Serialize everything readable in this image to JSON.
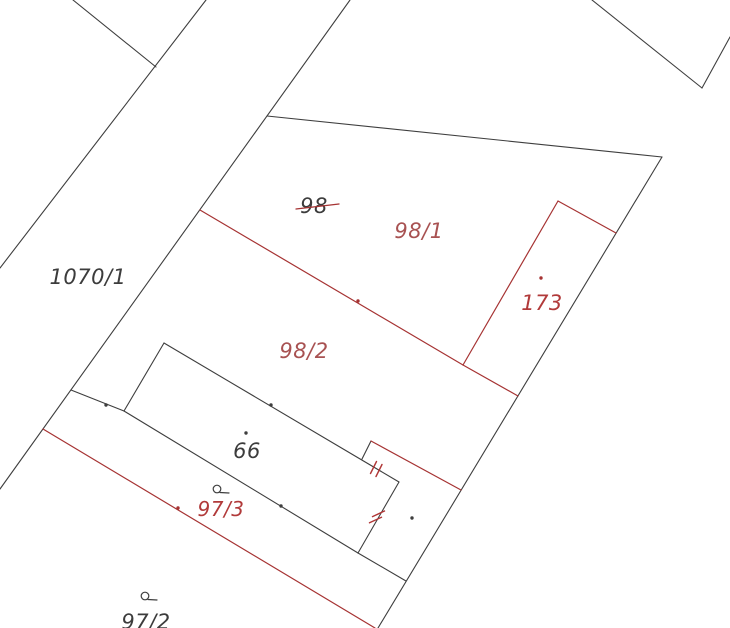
{
  "map": {
    "width": 730,
    "height": 628,
    "background": "#ffffff",
    "colors": {
      "boundary": "#3e3e3e",
      "new_boundary": "#a63333",
      "tick": "#b03636",
      "label_black": "#3c3c3c",
      "label_red": "#b13a3a",
      "label_red_muted": "#a85252"
    },
    "black_lines": [
      {
        "name": "road-west-boundary",
        "pts": [
          206,
          0,
          0,
          268
        ]
      },
      {
        "name": "field-line-northwest",
        "pts": [
          73,
          0,
          156,
          67
        ]
      },
      {
        "name": "road-east-boundary",
        "pts": [
          350,
          0,
          0,
          489
        ]
      },
      {
        "name": "parcel-98-north-boundary",
        "pts": [
          267,
          116,
          662,
          157
        ]
      },
      {
        "name": "parcel-98-east-boundary",
        "pts": [
          662,
          157,
          378,
          628
        ]
      },
      {
        "name": "northeast-corner-line-a",
        "pts": [
          592,
          0,
          702,
          88
        ]
      },
      {
        "name": "northeast-corner-line-b",
        "pts": [
          702,
          88,
          730,
          37
        ]
      },
      {
        "name": "road-to-building-connector",
        "pts": [
          71,
          390,
          124,
          411
        ]
      },
      {
        "name": "building-66-north-side",
        "pts": [
          164,
          343,
          399,
          482
        ]
      },
      {
        "name": "building-66-east-side",
        "pts": [
          399,
          482,
          358,
          553
        ]
      },
      {
        "name": "building-66-south-side",
        "pts": [
          358,
          553,
          124,
          411
        ]
      },
      {
        "name": "building-66-west-side",
        "pts": [
          124,
          411,
          164,
          343
        ]
      },
      {
        "name": "building-corner-spur",
        "pts": [
          362,
          459,
          371,
          441
        ]
      },
      {
        "name": "south-side-extension",
        "pts": [
          358,
          553,
          406,
          581
        ]
      }
    ],
    "red_lines": [
      {
        "name": "new-boundary-98-1-98-2-a",
        "pts": [
          200,
          210,
          463,
          365
        ]
      },
      {
        "name": "new-boundary-98-1-98-2-b",
        "pts": [
          463,
          365,
          518,
          396
        ]
      },
      {
        "name": "new-parcel-173-north-side",
        "pts": [
          558,
          201,
          616,
          233
        ]
      },
      {
        "name": "new-parcel-173-west-side",
        "pts": [
          558,
          201,
          463,
          365
        ]
      },
      {
        "name": "new-boundary-97-3-north",
        "pts": [
          371,
          441,
          461,
          490
        ]
      },
      {
        "name": "new-boundary-97-3-south",
        "pts": [
          43,
          429,
          375,
          628
        ]
      }
    ],
    "strike_line": {
      "name": "old-number-98-strikethrough",
      "pts": [
        296,
        209,
        339,
        204
      ]
    },
    "tick_marks": [
      {
        "name": "merge-tick-north-a",
        "pts": [
          370.5,
          473.5,
          376.5,
          461.5
        ]
      },
      {
        "name": "merge-tick-north-b",
        "pts": [
          376.0,
          476.5,
          382.0,
          464.5
        ]
      },
      {
        "name": "merge-tick-east-a",
        "pts": [
          369.5,
          522.8,
          381.5,
          517.2
        ]
      },
      {
        "name": "merge-tick-east-b",
        "pts": [
          372.5,
          516.6,
          384.5,
          511.0
        ]
      }
    ],
    "dots": [
      {
        "name": "boundary-point-dot",
        "x": 271,
        "y": 405,
        "color": "boundary"
      },
      {
        "name": "boundary-point-dot",
        "x": 106,
        "y": 405,
        "color": "boundary"
      },
      {
        "name": "boundary-point-dot",
        "x": 281,
        "y": 506,
        "color": "boundary"
      },
      {
        "name": "boundary-point-dot",
        "x": 246,
        "y": 433,
        "color": "boundary"
      },
      {
        "name": "boundary-point-dot",
        "x": 412,
        "y": 518,
        "color": "boundary"
      },
      {
        "name": "boundary-point-dot",
        "x": 541,
        "y": 278,
        "color": "new_boundary"
      },
      {
        "name": "boundary-point-dot",
        "x": 358,
        "y": 301,
        "color": "new_boundary"
      },
      {
        "name": "boundary-point-dot",
        "x": 178,
        "y": 508,
        "color": "new_boundary"
      }
    ],
    "survey_markers": [
      {
        "name": "survey-marker-97-3",
        "cx": 217,
        "cy": 489,
        "r": 3.8,
        "tail": [
          220,
          492.5,
          229,
          493
        ]
      },
      {
        "name": "survey-marker-97-2",
        "cx": 145,
        "cy": 596,
        "r": 3.8,
        "tail": [
          148,
          599.5,
          157,
          600
        ]
      }
    ],
    "labels": [
      {
        "name": "parcel-label-1070-1",
        "text": "1070/1",
        "x": 88,
        "y": 277,
        "size": 21,
        "color": "label_black"
      },
      {
        "name": "parcel-label-98-old",
        "text": "98",
        "x": 314,
        "y": 206,
        "size": 21,
        "color": "label_black"
      },
      {
        "name": "parcel-label-98-1",
        "text": "98/1",
        "x": 419,
        "y": 231,
        "size": 21,
        "color": "label_red_muted"
      },
      {
        "name": "parcel-label-98-2",
        "text": "98/2",
        "x": 304,
        "y": 351,
        "size": 21,
        "color": "label_red_muted"
      },
      {
        "name": "parcel-label-173",
        "text": "173",
        "x": 542,
        "y": 303,
        "size": 21,
        "color": "label_red"
      },
      {
        "name": "building-label-66",
        "text": "66",
        "x": 247,
        "y": 451,
        "size": 21,
        "color": "label_black"
      },
      {
        "name": "parcel-label-97-3",
        "text": "97/3",
        "x": 221,
        "y": 509,
        "size": 20,
        "color": "label_red"
      },
      {
        "name": "parcel-label-97-2",
        "text": "97/2",
        "x": 146,
        "y": 622,
        "size": 21,
        "color": "label_black"
      }
    ]
  }
}
